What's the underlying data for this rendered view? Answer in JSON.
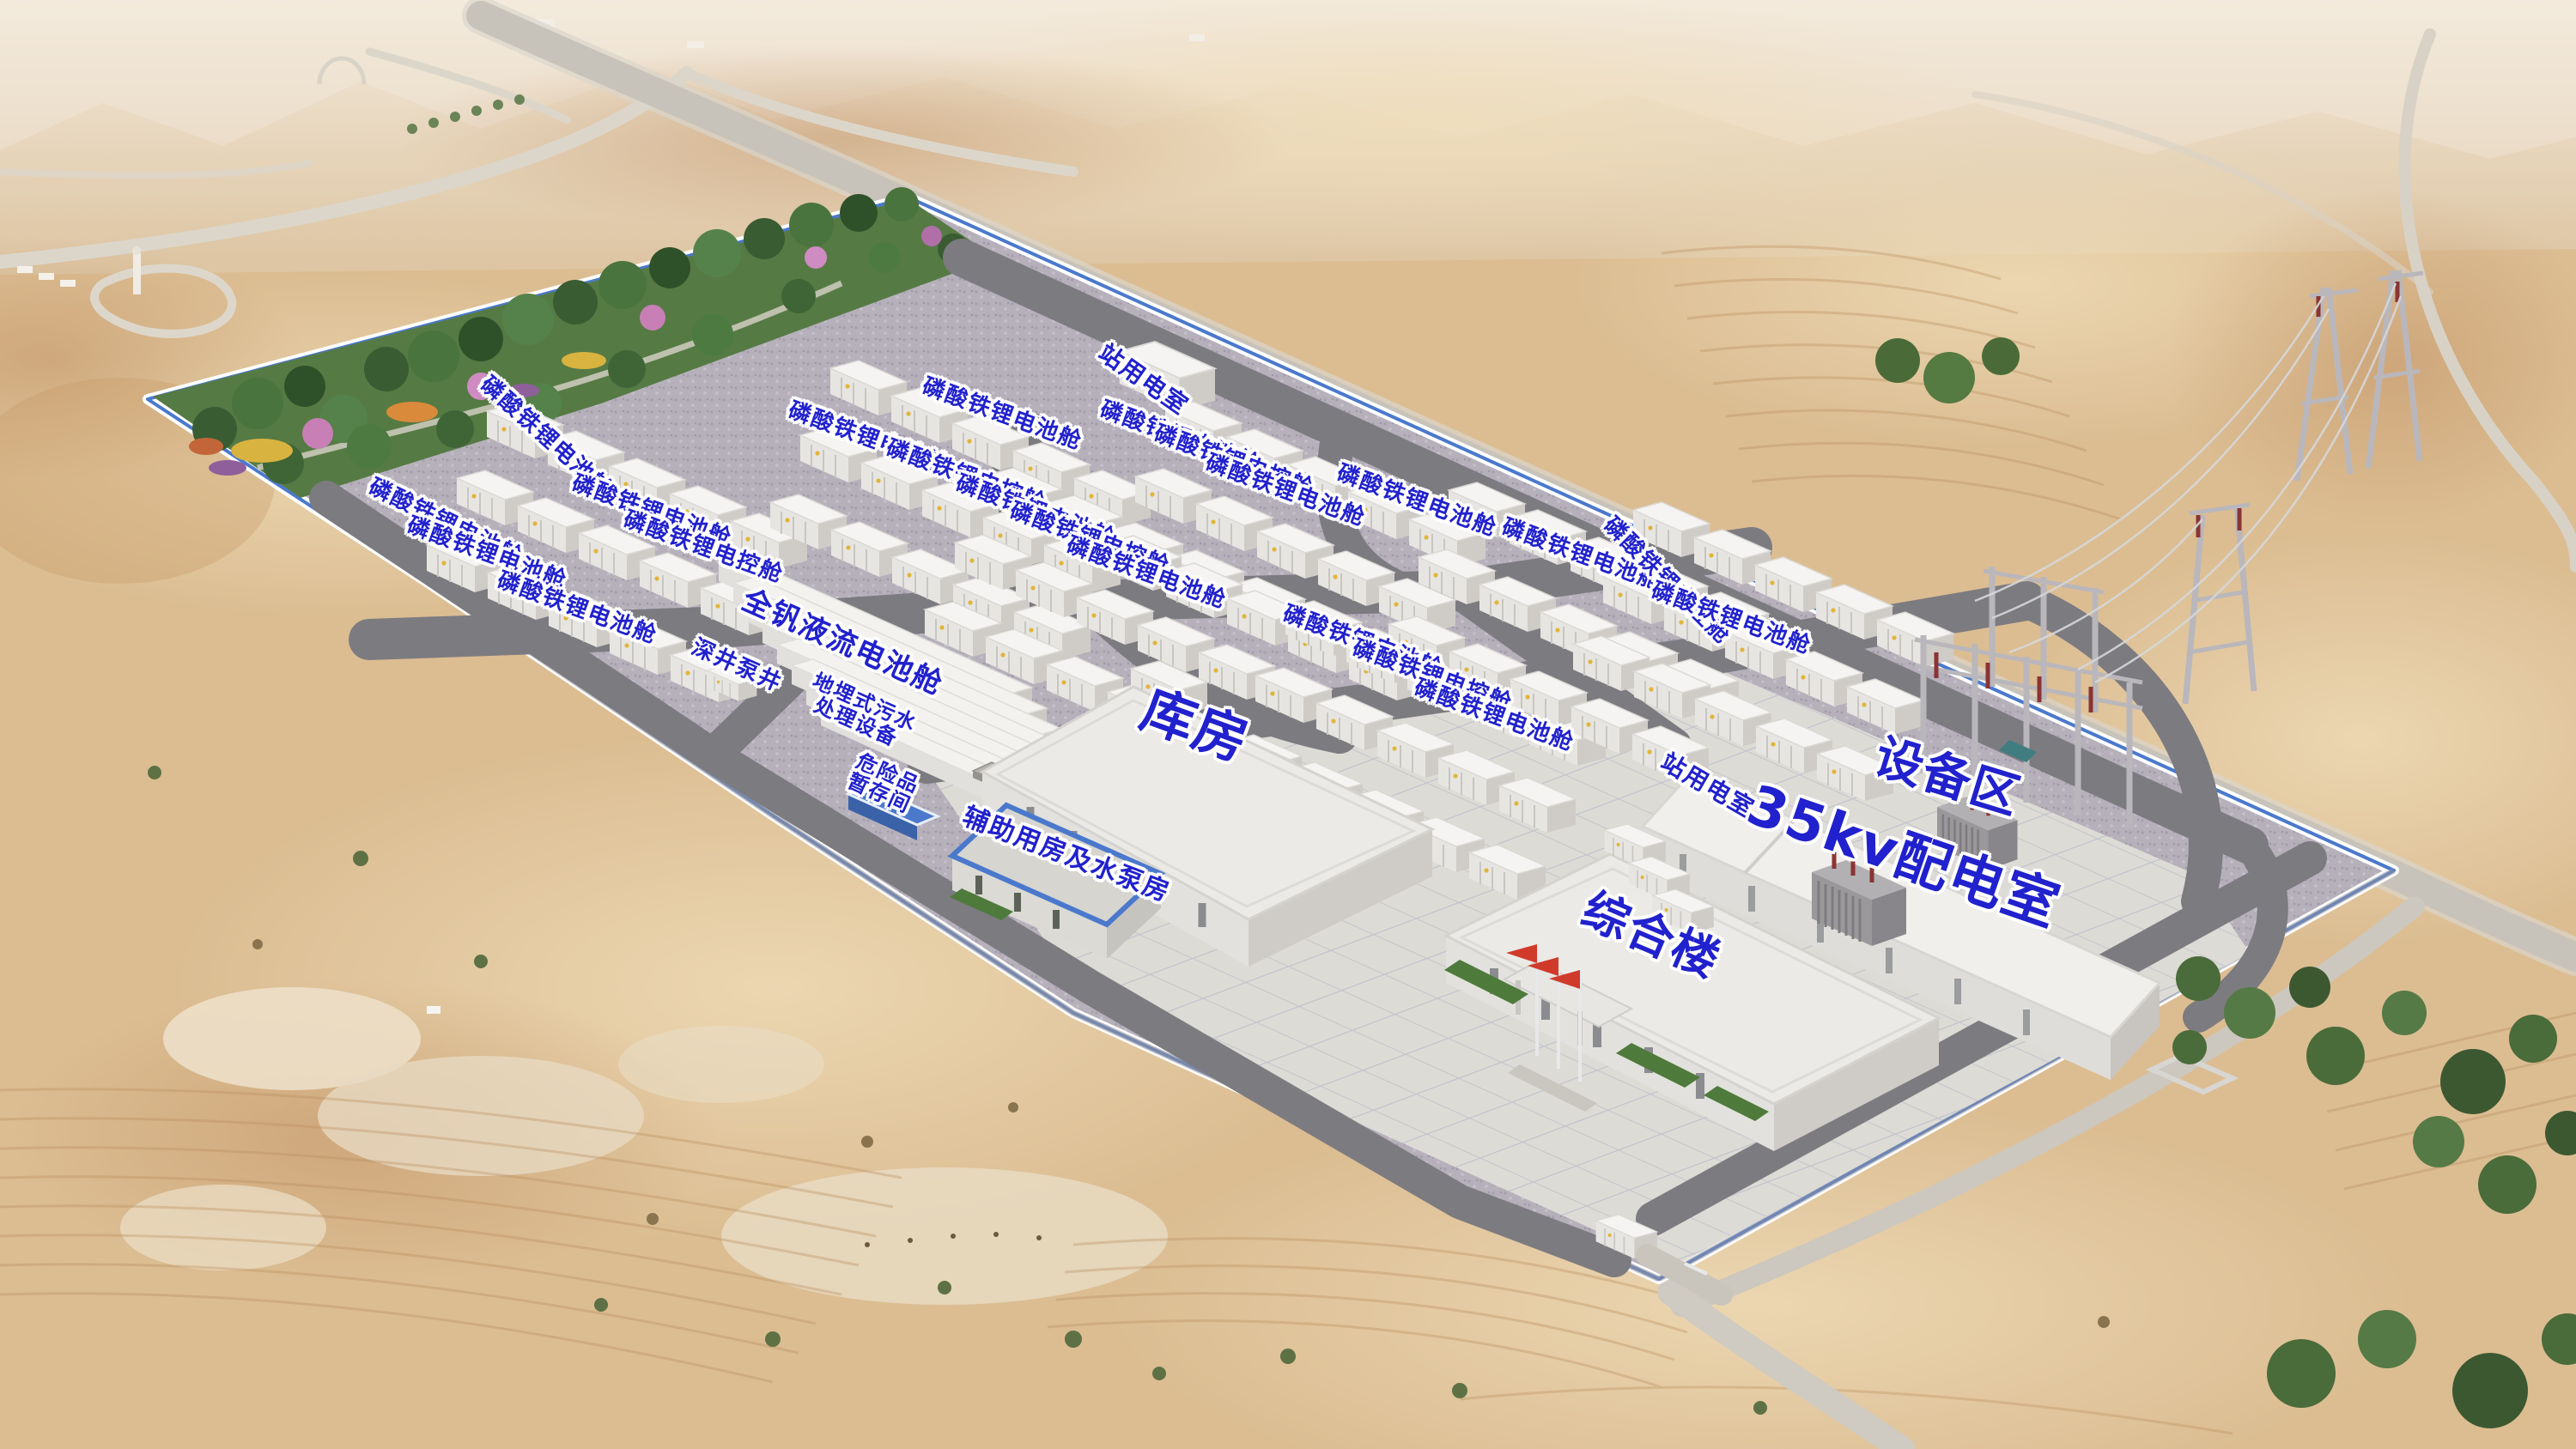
{
  "scene_type": "aerial-rendering-energy-storage-station",
  "colors": {
    "label_text": "#2121ce",
    "label_halo": "#ffffff",
    "wall_accent": "#4a79cc",
    "flag_red": "#d03a2a",
    "road_asphalt": "#7c7b80",
    "gravel_ground": "#b6b0bb",
    "sand": "#dcbd92",
    "forest_green": "#49743d",
    "container_white": "#f4f3f1"
  },
  "labels": [
    {
      "id": "station-power-room-north",
      "text": "站用电室",
      "x": 44.4,
      "y": 26.2,
      "r": 35,
      "s": 28
    },
    {
      "id": "lfp-battery-cabin-1",
      "text": "磷酸铁锂电池舱",
      "x": 38.9,
      "y": 28.6,
      "r": 20,
      "s": 26
    },
    {
      "id": "lfp-battery-cabin-2",
      "text": "磷酸铁锂电池舱",
      "x": 33.7,
      "y": 30.3,
      "r": 20,
      "s": 26
    },
    {
      "id": "lfp-control-cabin-1",
      "text": "磷酸铁锂电控舱",
      "x": 37.5,
      "y": 32.9,
      "r": 20,
      "s": 26
    },
    {
      "id": "lfp-battery-cabin-3",
      "text": "磷酸铁锂电池舱",
      "x": 21.2,
      "y": 30.2,
      "r": 42,
      "s": 26
    },
    {
      "id": "lfp-battery-cabin-4",
      "text": "磷酸铁锂电池舱",
      "x": 17.3,
      "y": 36.1,
      "r": 26,
      "s": 26
    },
    {
      "id": "lfp-battery-cabin-5",
      "text": "磷酸铁锂电池舱",
      "x": 25.3,
      "y": 35.3,
      "r": 20,
      "s": 26
    },
    {
      "id": "lfp-control-cabin-2",
      "text": "磷酸铁锂电控舱",
      "x": 27.3,
      "y": 37.8,
      "r": 20,
      "s": 26
    },
    {
      "id": "lfp-battery-cabin-6",
      "text": "磷酸铁锂电池舱",
      "x": 18.9,
      "y": 38.2,
      "r": 20,
      "s": 26
    },
    {
      "id": "lfp-battery-cabin-7",
      "text": "磷酸铁锂电池舱",
      "x": 22.4,
      "y": 42.0,
      "r": 20,
      "s": 26
    },
    {
      "id": "vanadium-flow-battery-cabin",
      "text": "全钒液流电池舱",
      "x": 32.7,
      "y": 44.4,
      "r": 24,
      "s": 34
    },
    {
      "id": "deep-well-pump",
      "text": "深井泵井",
      "x": 28.6,
      "y": 46.0,
      "r": 24,
      "s": 26
    },
    {
      "id": "buried-sewage-treatment",
      "text": "地埋式污水\n处理设备",
      "x": 33.4,
      "y": 49.2,
      "r": 24,
      "s": 24
    },
    {
      "id": "hazardous-storage-room",
      "text": "危险品\n暂存间",
      "x": 34.3,
      "y": 54.1,
      "r": 24,
      "s": 24
    },
    {
      "id": "auxiliary-pump-house",
      "text": "辅助用房及水泵房",
      "x": 41.4,
      "y": 59.0,
      "r": 21,
      "s": 30
    },
    {
      "id": "warehouse",
      "text": "库房",
      "x": 46.4,
      "y": 50.1,
      "r": 20,
      "s": 62
    },
    {
      "id": "complex-building",
      "text": "综合楼",
      "x": 64.1,
      "y": 64.6,
      "r": 23,
      "s": 54
    },
    {
      "id": "lfp-battery-cabin-8",
      "text": "磷酸铁锂电池舱",
      "x": 40.2,
      "y": 35.3,
      "r": 20,
      "s": 26
    },
    {
      "id": "lfp-control-cabin-3",
      "text": "磷酸铁锂电控舱",
      "x": 42.3,
      "y": 37.2,
      "r": 20,
      "s": 26
    },
    {
      "id": "lfp-battery-cabin-9",
      "text": "磷酸铁锂电池舱",
      "x": 44.5,
      "y": 39.6,
      "r": 20,
      "s": 26
    },
    {
      "id": "lfp-battery-cabin-10",
      "text": "磷酸铁锂电池舱",
      "x": 45.8,
      "y": 30.2,
      "r": 20,
      "s": 26
    },
    {
      "id": "lfp-control-cabin-4",
      "text": "磷酸铁锂电控舱",
      "x": 47.9,
      "y": 31.9,
      "r": 20,
      "s": 26
    },
    {
      "id": "lfp-battery-cabin-11",
      "text": "磷酸铁锂电池舱",
      "x": 49.9,
      "y": 33.9,
      "r": 20,
      "s": 26
    },
    {
      "id": "lfp-battery-cabin-12",
      "text": "磷酸铁锂电池舱",
      "x": 55.0,
      "y": 34.6,
      "r": 20,
      "s": 26
    },
    {
      "id": "lfp-battery-cabin-13",
      "text": "磷酸铁锂电池舱",
      "x": 52.9,
      "y": 44.3,
      "r": 20,
      "s": 26
    },
    {
      "id": "lfp-control-cabin-5",
      "text": "磷酸铁锂电控舱",
      "x": 55.6,
      "y": 46.7,
      "r": 20,
      "s": 26
    },
    {
      "id": "lfp-battery-cabin-14",
      "text": "磷酸铁锂电池舱",
      "x": 58.0,
      "y": 49.4,
      "r": 20,
      "s": 26
    },
    {
      "id": "lfp-battery-cabin-15",
      "text": "磷酸铁锂电池舱",
      "x": 61.4,
      "y": 38.3,
      "r": 20,
      "s": 26
    },
    {
      "id": "lfp-control-cabin-6",
      "text": "磷酸铁锂电控舱",
      "x": 64.7,
      "y": 40.1,
      "r": 45,
      "s": 26
    },
    {
      "id": "lfp-battery-cabin-16",
      "text": "磷酸铁锂电池舱",
      "x": 67.2,
      "y": 42.7,
      "r": 20,
      "s": 26
    },
    {
      "id": "station-power-room-south",
      "text": "站用电室",
      "x": 66.3,
      "y": 54.2,
      "r": 30,
      "s": 28
    },
    {
      "id": "distribution-room-35kv",
      "text": "35kv配电室",
      "x": 73.9,
      "y": 59.1,
      "r": 19,
      "s": 64
    },
    {
      "id": "equipment-area",
      "text": "设备区",
      "x": 75.6,
      "y": 53.7,
      "r": 17,
      "s": 56
    }
  ]
}
